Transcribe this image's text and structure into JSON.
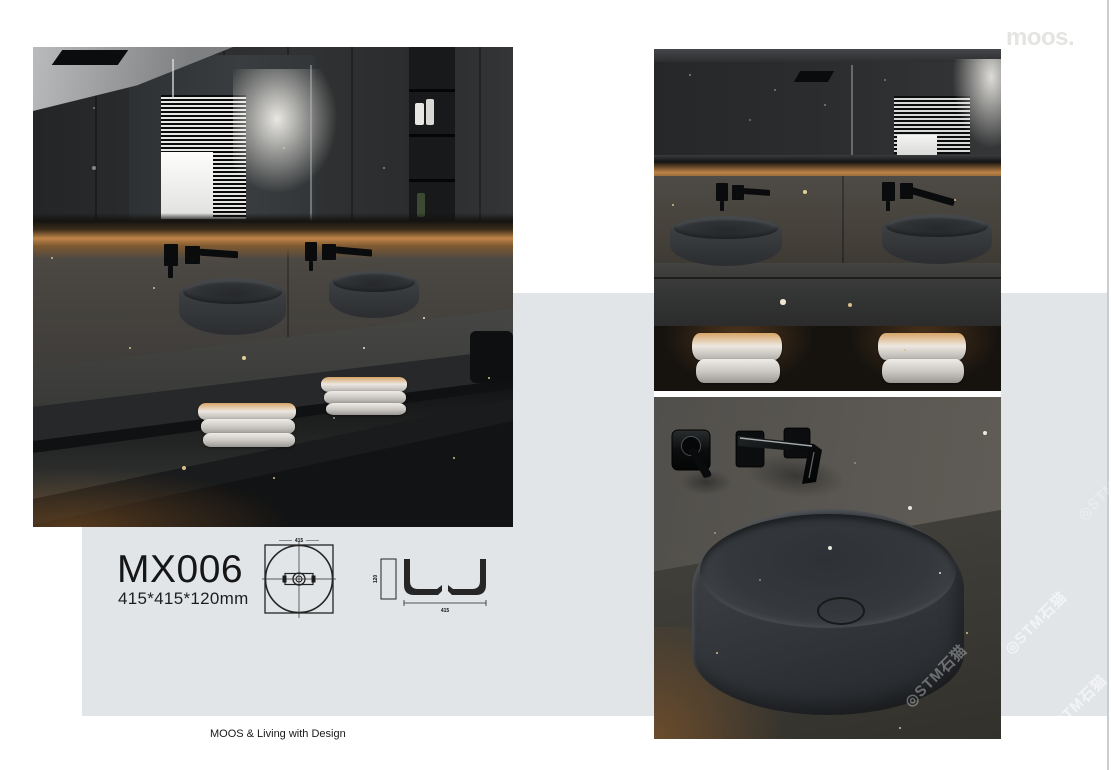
{
  "brand": {
    "logo": "moos.",
    "footer": "MOOS & Living with Design"
  },
  "product": {
    "model": "MX006",
    "size": "415*415*120mm"
  },
  "drawings": {
    "top_view": {
      "width_label": "415"
    },
    "side_view": {
      "height_label": "120",
      "width_label": "415"
    }
  },
  "watermark": {
    "text": "◎STM石猫"
  },
  "colors": {
    "page_bg": "#ffffff",
    "panel_gray": "#e2e5e8",
    "edge_line": "#c9cdd0",
    "logo_gray": "#e4e4e1",
    "text_dark": "#161616",
    "led_glow_amber": "#c08448",
    "wall_taupe": "#4a4741",
    "basin_gray": "#34383b",
    "towel_white": "#e6e3de"
  }
}
